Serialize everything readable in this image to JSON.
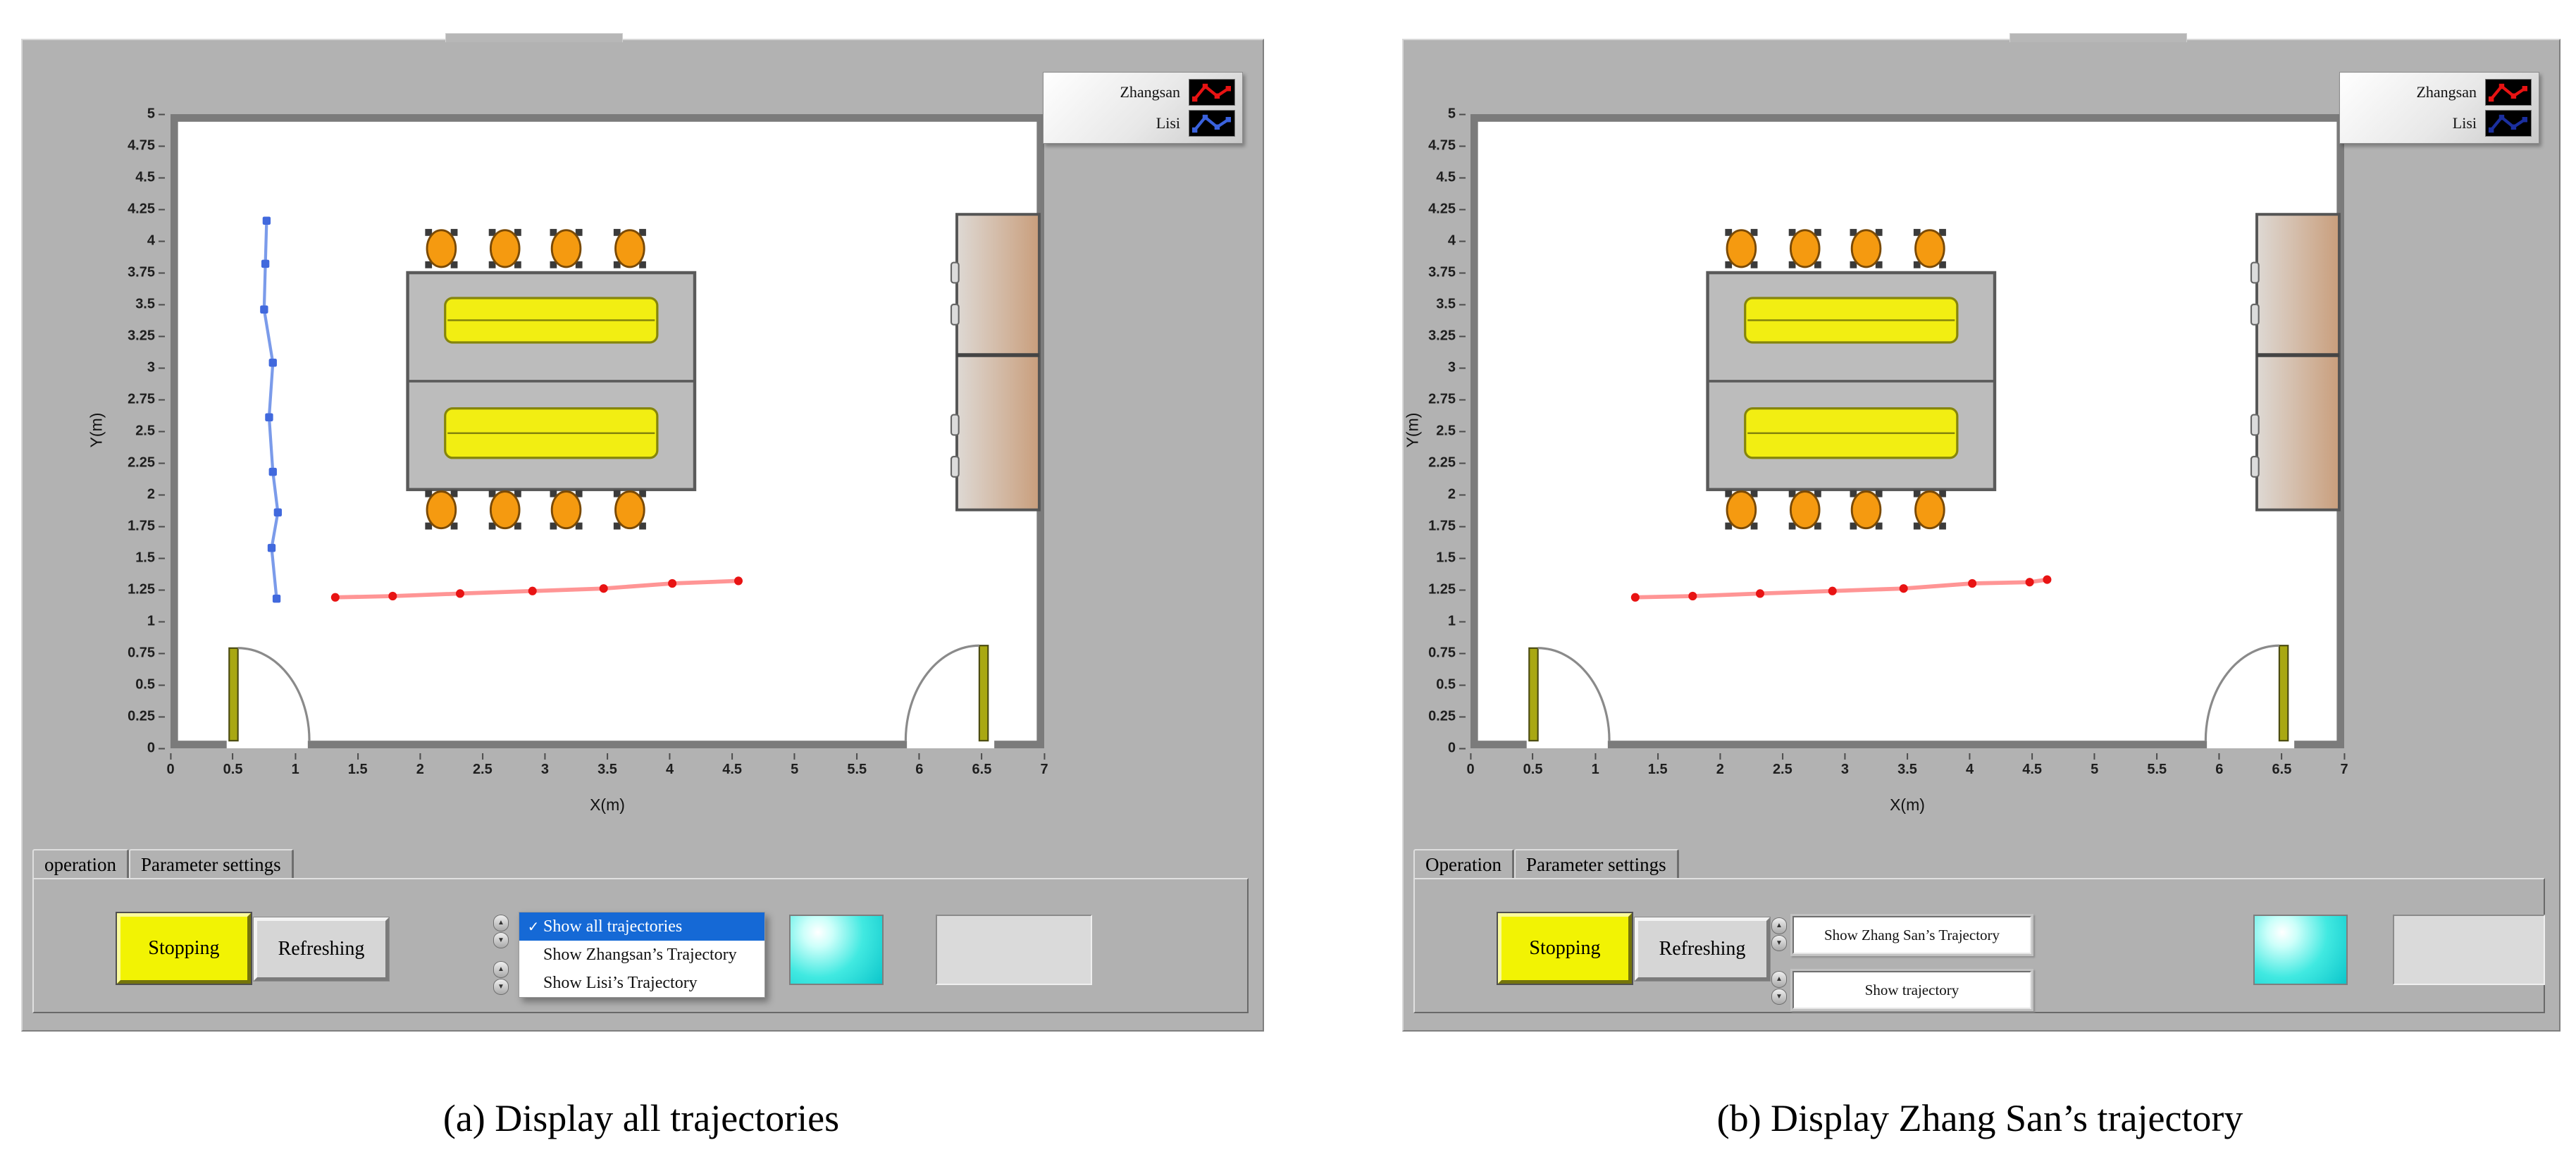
{
  "captions": {
    "a": "(a) Display all trajectories",
    "b": "(b) Display Zhang San’s trajectory"
  },
  "panels": [
    {
      "tabs": [
        "operation",
        "Parameter settings"
      ],
      "stop_button": "Stopping",
      "refresh_button": "Refreshing",
      "legend": [
        {
          "label": "Zhangsan",
          "color": "#e81313"
        },
        {
          "label": "Lisi",
          "color": "#3a62dd"
        }
      ],
      "trajectory_menu": {
        "open": true,
        "check_glyph": "✓",
        "items": [
          "Show all trajectories",
          "Show Zhangsan’s Trajectory",
          "Show Lisi’s Trajectory"
        ],
        "selected_index": 0
      }
    },
    {
      "tabs": [
        "Operation",
        "Parameter settings"
      ],
      "stop_button": "Stopping",
      "refresh_button": "Refreshing",
      "legend": [
        {
          "label": "Zhangsan",
          "color": "#e81313"
        },
        {
          "label": "Lisi",
          "color": "#1b2f9e"
        }
      ],
      "dropdowns": [
        "Show Zhang San’s Trajectory",
        "Show trajectory"
      ]
    }
  ],
  "room": {
    "x_range": [
      0,
      7
    ],
    "y_range": [
      0,
      5
    ],
    "wall_thickness": 0.06,
    "door_gaps": [
      [
        0.45,
        1.1
      ],
      [
        5.9,
        6.6
      ]
    ],
    "doors": [
      {
        "hinge_x": 0.47,
        "leaf_height": 0.73,
        "swing_dir": 1
      },
      {
        "hinge_x": 6.55,
        "leaf_height": 0.75,
        "swing_dir": -1
      }
    ],
    "table_block": {
      "x": [
        1.9,
        4.2
      ],
      "y": [
        2.04,
        3.75
      ]
    },
    "desks": [
      {
        "x": [
          2.2,
          3.9
        ],
        "y": [
          3.2,
          3.55
        ]
      },
      {
        "x": [
          2.2,
          3.9
        ],
        "y": [
          2.29,
          2.68
        ]
      }
    ],
    "chair_xs": [
      2.17,
      2.68,
      3.17,
      3.68
    ],
    "chair_rows_y": [
      3.94,
      1.88
    ],
    "cabinet": {
      "x": [
        6.3,
        6.96
      ],
      "y": [
        1.88,
        4.21
      ],
      "divider_y": 3.1,
      "handle_ys": [
        3.75,
        3.42,
        2.55,
        2.22
      ]
    },
    "colors": {
      "wall": "#7b7b7b",
      "table": "#bcbcbc",
      "desk": "#f2ee12",
      "chair": "#f59a10",
      "cabinet_left": "#ded9d4",
      "cabinet_right": "#c99e7c",
      "door": "#a9a812"
    }
  },
  "chart_data": [
    {
      "type": "line",
      "title": "Indoor room map with all personnel trajectories",
      "xlabel": "X(m)",
      "ylabel": "Y(m)",
      "xlim": [
        0,
        7
      ],
      "ylim": [
        0,
        5
      ],
      "xtick_step": 0.5,
      "ytick_step": 0.25,
      "grid": false,
      "legend_position": "top-right",
      "series": [
        {
          "name": "Zhangsan",
          "marker": "circle",
          "color": "#e81313",
          "line_color": "#ff9595",
          "points": [
            [
              1.32,
              1.19
            ],
            [
              1.78,
              1.2
            ],
            [
              2.32,
              1.22
            ],
            [
              2.9,
              1.24
            ],
            [
              3.47,
              1.26
            ],
            [
              4.02,
              1.3
            ],
            [
              4.55,
              1.32
            ]
          ]
        },
        {
          "name": "Lisi",
          "marker": "square",
          "color": "#4169dd",
          "line_color": "#7b9bea",
          "points": [
            [
              0.77,
              4.16
            ],
            [
              0.76,
              3.82
            ],
            [
              0.75,
              3.46
            ],
            [
              0.82,
              3.04
            ],
            [
              0.79,
              2.61
            ],
            [
              0.82,
              2.18
            ],
            [
              0.86,
              1.86
            ],
            [
              0.81,
              1.58
            ],
            [
              0.85,
              1.18
            ]
          ]
        }
      ]
    },
    {
      "type": "line",
      "title": "Indoor room map with Zhang San’s trajectory",
      "xlabel": "X(m)",
      "ylabel": "Y(m)",
      "xlim": [
        0,
        7
      ],
      "ylim": [
        0,
        5
      ],
      "xtick_step": 0.5,
      "ytick_step": 0.25,
      "grid": false,
      "legend_position": "top-right",
      "series": [
        {
          "name": "Zhangsan",
          "marker": "circle",
          "color": "#e81313",
          "line_color": "#ff9595",
          "points": [
            [
              1.32,
              1.19
            ],
            [
              1.78,
              1.2
            ],
            [
              2.32,
              1.22
            ],
            [
              2.9,
              1.24
            ],
            [
              3.47,
              1.26
            ],
            [
              4.02,
              1.3
            ],
            [
              4.48,
              1.31
            ],
            [
              4.62,
              1.33
            ]
          ]
        }
      ]
    }
  ]
}
